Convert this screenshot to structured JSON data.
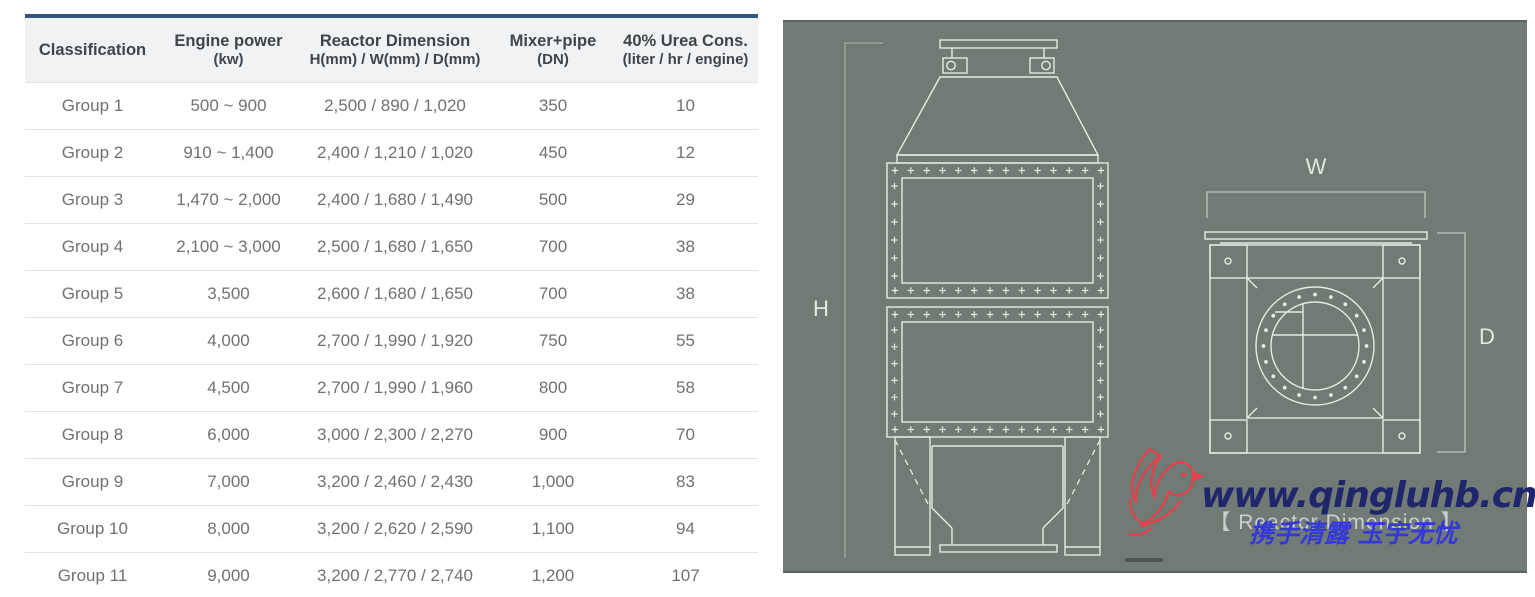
{
  "table": {
    "columns": [
      {
        "title": "Classification",
        "sub": ""
      },
      {
        "title": "Engine power",
        "sub": "(kw)"
      },
      {
        "title": "Reactor Dimension",
        "sub": "H(mm) / W(mm) / D(mm)"
      },
      {
        "title": "Mixer+pipe",
        "sub": "(DN)"
      },
      {
        "title": "40% Urea Cons.",
        "sub": "(liter / hr / engine)"
      }
    ],
    "rows": [
      [
        "Group 1",
        "500 ~ 900",
        "2,500 / 890 / 1,020",
        "350",
        "10"
      ],
      [
        "Group 2",
        "910 ~ 1,400",
        "2,400 / 1,210 / 1,020",
        "450",
        "12"
      ],
      [
        "Group 3",
        "1,470 ~ 2,000",
        "2,400 / 1,680 / 1,490",
        "500",
        "29"
      ],
      [
        "Group 4",
        "2,100 ~ 3,000",
        "2,500 / 1,680 / 1,650",
        "700",
        "38"
      ],
      [
        "Group 5",
        "3,500",
        "2,600 / 1,680 / 1,650",
        "700",
        "38"
      ],
      [
        "Group 6",
        "4,000",
        "2,700 / 1,990 / 1,920",
        "750",
        "55"
      ],
      [
        "Group 7",
        "4,500",
        "2,700 / 1,990 / 1,960",
        "800",
        "58"
      ],
      [
        "Group 8",
        "6,000",
        "3,000 / 2,300 / 2,270",
        "900",
        "70"
      ],
      [
        "Group 9",
        "7,000",
        "3,200 / 2,460 / 2,430",
        "1,000",
        "83"
      ],
      [
        "Group 10",
        "8,000",
        "3,200 / 2,620 / 2,590",
        "1,100",
        "94"
      ],
      [
        "Group 11",
        "9,000",
        "3,200 / 2,770 / 2,740",
        "1,200",
        "107"
      ]
    ]
  },
  "diagram": {
    "labels": {
      "height": "H",
      "width": "W",
      "depth": "D"
    },
    "caption": "【 Reactor Dimension 】",
    "watermark": {
      "url": "www.qingluhb.cn",
      "slogan": "携手清露 玉宇无忧"
    }
  },
  "colors": {
    "table_accent": "#33567e",
    "header_bg": "#f1f2f3",
    "header_text": "#3f444d",
    "body_text": "#6f7173",
    "row_divider": "#e3e3e3",
    "panel_bg": "#6f7b74",
    "line": "#e6ebe4",
    "dim_line": "#ccd5ce",
    "label_text": "#e3e8e2",
    "caption_text": "#e0e4e0",
    "url_navy": "#20266b",
    "slogan_blue": "#3438d8",
    "bird_red": "#e8404a"
  }
}
